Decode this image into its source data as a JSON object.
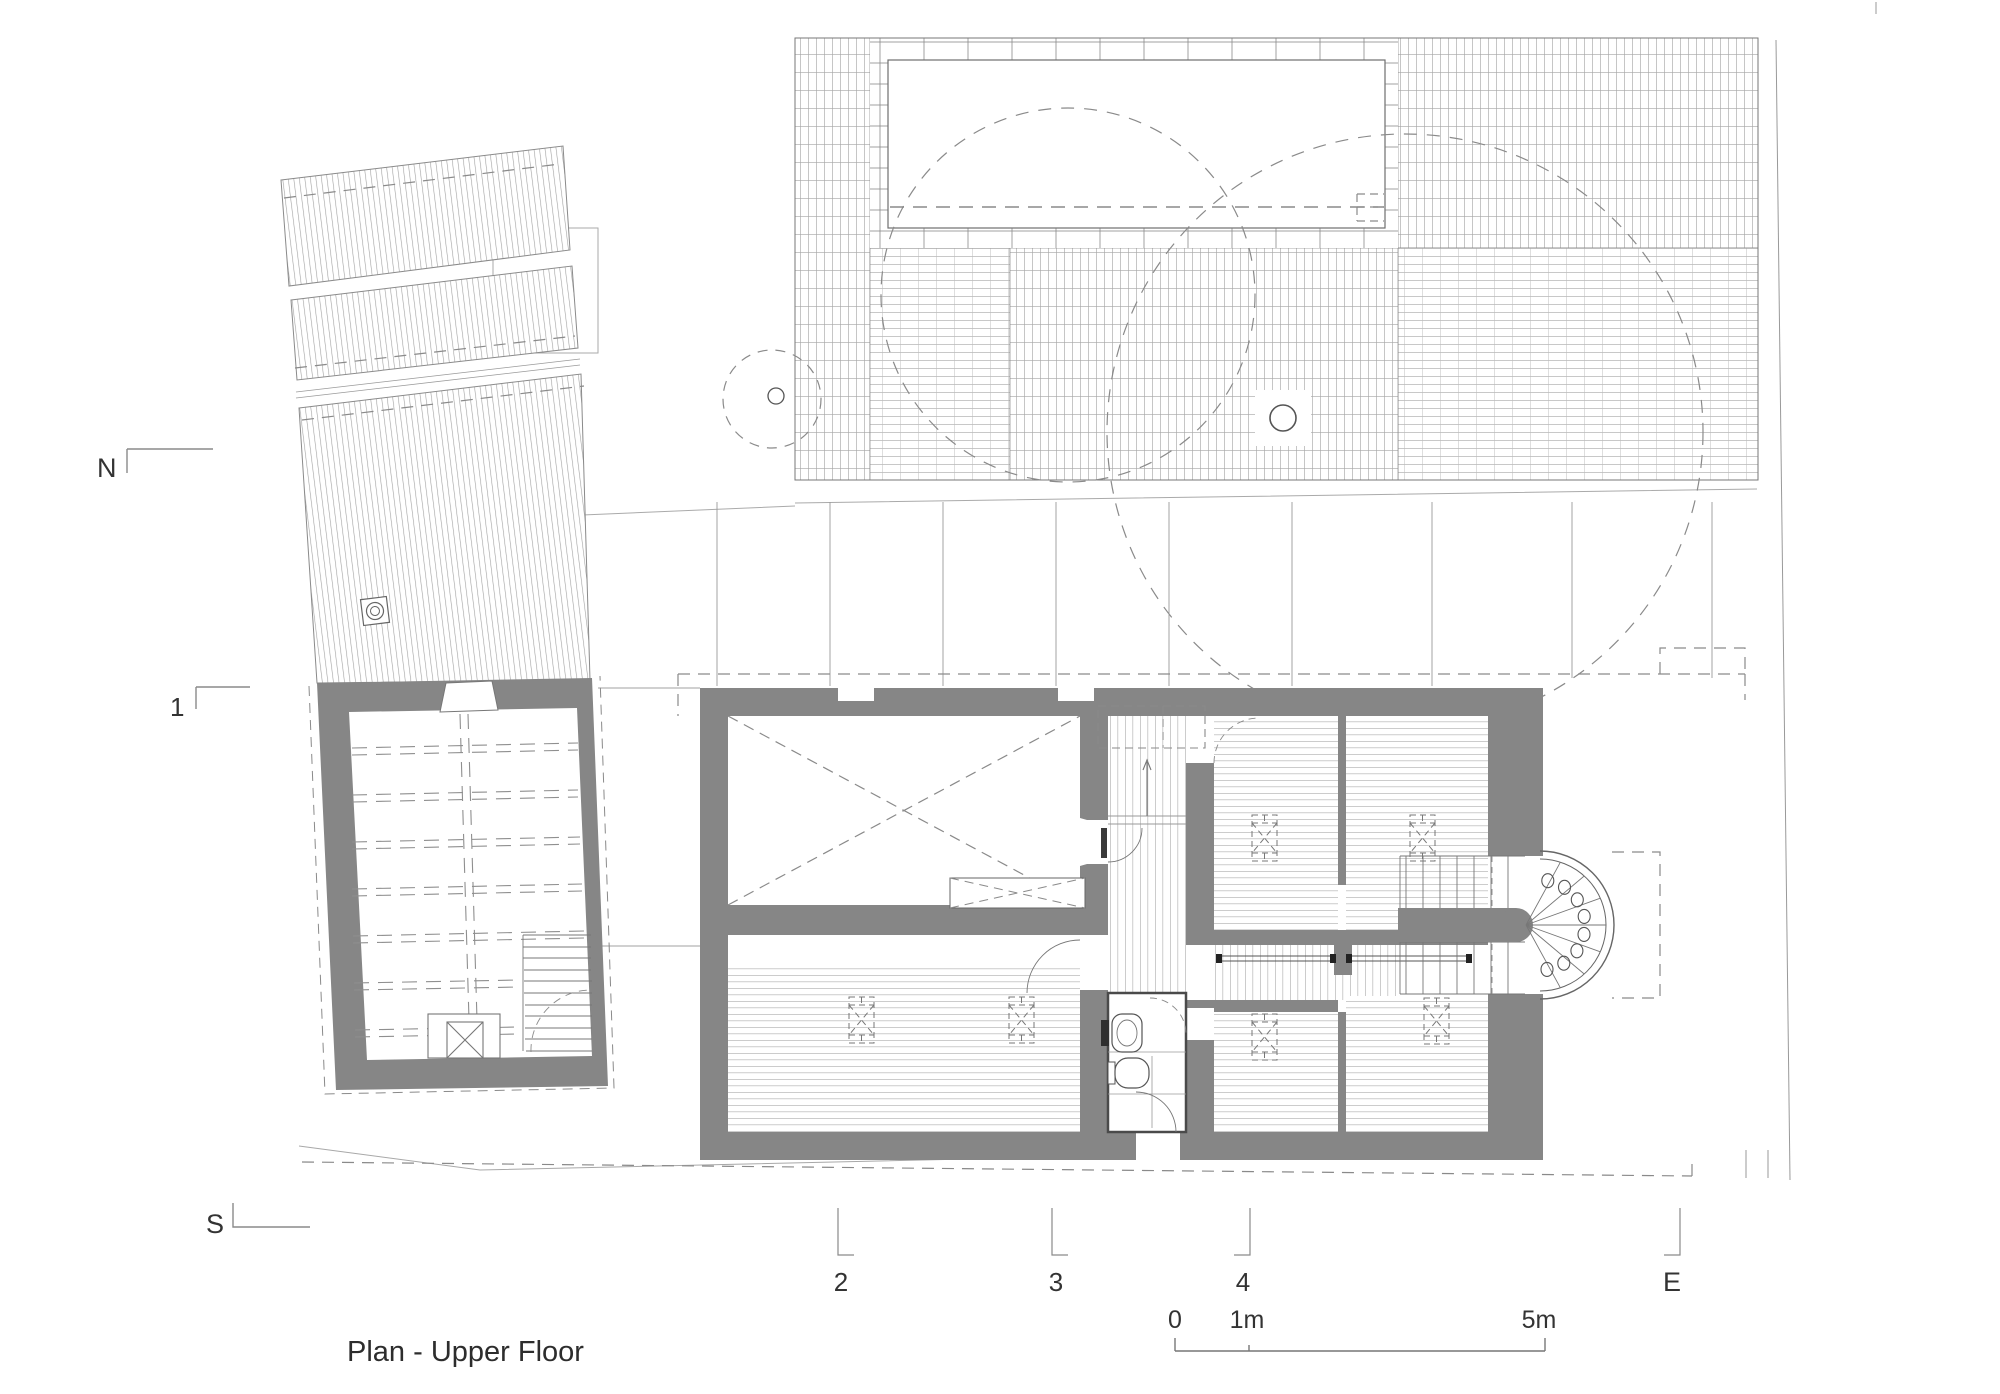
{
  "title": "Plan - Upper Floor",
  "compass": {
    "north": "N",
    "south": "S",
    "east": "E"
  },
  "grid": {
    "axis1": "1",
    "axis2": "2",
    "axis3": "3",
    "axis4": "4"
  },
  "scale": {
    "zero": "0",
    "one_m": "1m",
    "five_m": "5m"
  },
  "colors": {
    "wall": "#868686",
    "outline": "#6f6f6f",
    "thin_line": "#9a9a9a",
    "hatch_roof": "#a8a8a8",
    "hatch_floor": "#b0b0b0",
    "dash": "#8a8a8a",
    "fixture": "#555555",
    "text": "#333333",
    "background": "#ffffff"
  },
  "legend_symbols": {
    "roof_window": "dashed-rect-hourglass-icon",
    "rooflight": "concentric-circles-icon",
    "chimney_roof": "circle-in-square-icon",
    "chimney_hearth": "box-with-x-icon",
    "tree": "dashed-circle-icon",
    "stair_apse": "radial-treads-semicircle"
  }
}
